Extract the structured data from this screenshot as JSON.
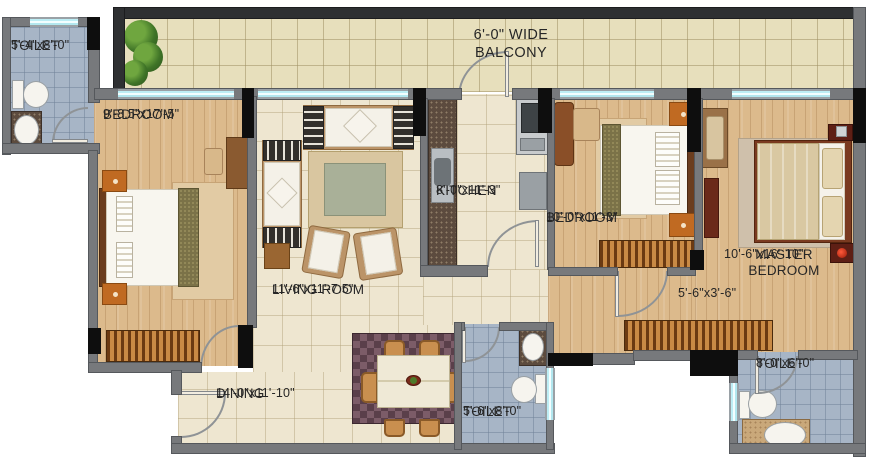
{
  "balcony": {
    "label": "6'-0\" WIDE BALCONY"
  },
  "rooms": {
    "toilet_top_left": {
      "name": "TOILET",
      "dims": "5'-4\"x8'-0\""
    },
    "bedroom1": {
      "name": "BEDROOM",
      "dims": "9'-8.5\"x17'-5\""
    },
    "living_room": {
      "name": "LIVING ROOM",
      "dims": "11'-6\"x11'-7.5\""
    },
    "kitchen": {
      "name": "KITCHEN",
      "dims": "8'-0\"x11'-3\""
    },
    "bedroom2": {
      "name": "BEDROOM",
      "dims": "10'-0\"x11'-3\""
    },
    "master_bedroom": {
      "name": "MASTER BEDROOM",
      "dims": "10'-6\"x16'-10\""
    },
    "passage": {
      "dims": "5'-6\"x3'-6\""
    },
    "dining": {
      "name": "DINING",
      "dims": "14'-0\"x11'-10\""
    },
    "toilet_bottom_center": {
      "name": "TOILET",
      "dims": "5'-6\"x8'-0\""
    },
    "toilet_bottom_right": {
      "name": "TOILET",
      "dims": "8'-0\"x6'-0\""
    }
  },
  "colors": {
    "wall": "#77797c",
    "window_glass": "#bdeef5",
    "wood_floor": "#dcba8c",
    "tile_floor": "#eee6d0",
    "balcony_floor": "#e7dfbc",
    "toilet_floor": "#a7b5c6",
    "nightstand_accent": "#c06a22",
    "label_text": "#262626"
  }
}
